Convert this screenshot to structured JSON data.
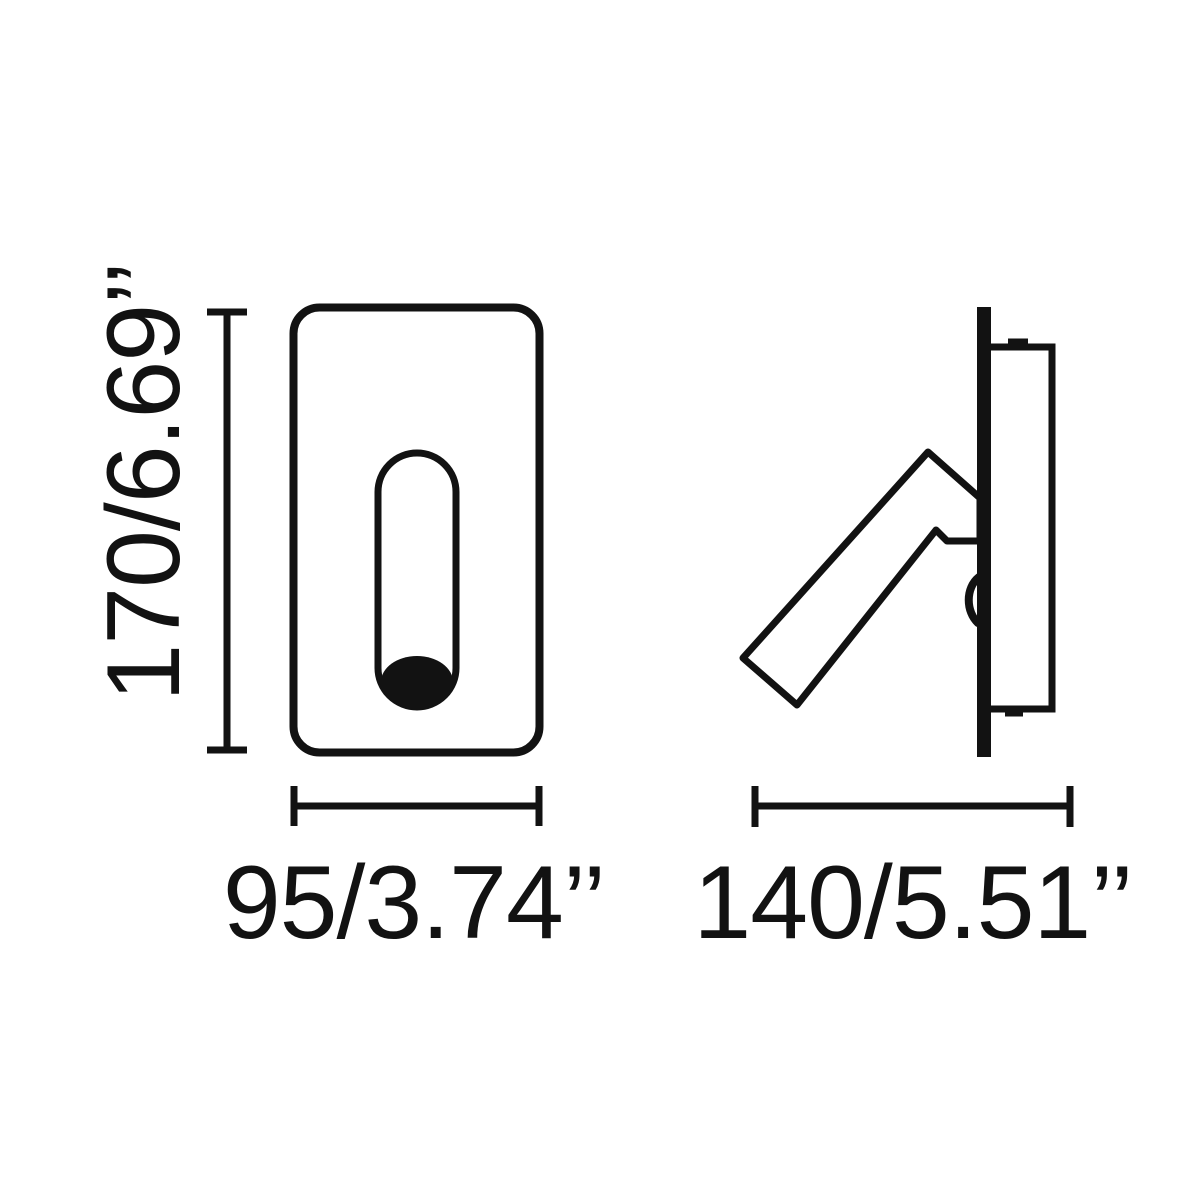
{
  "page": {
    "background_color": "#ffffff"
  },
  "drawing": {
    "ink_color": "#121212",
    "front_view": {
      "height_dimension_label": "170/6.69’’",
      "width_dimension_label": "95/3.74’’"
    },
    "side_view": {
      "depth_dimension_label": "140/5.51’’"
    }
  }
}
